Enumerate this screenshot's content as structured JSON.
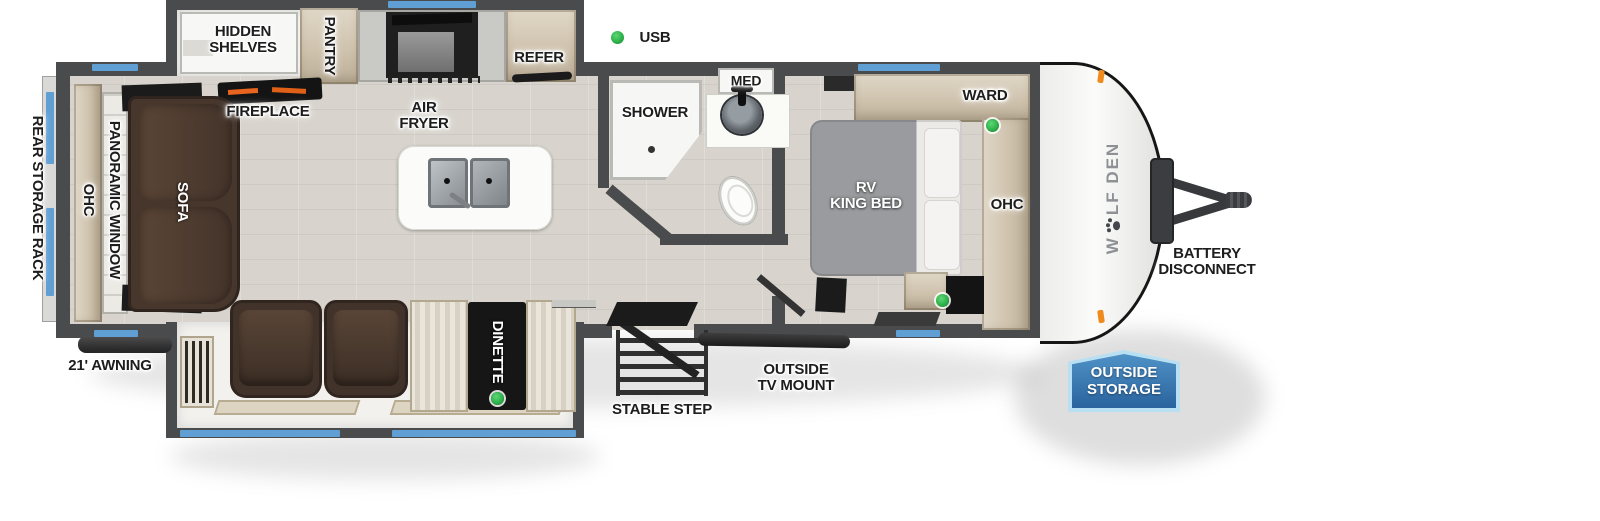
{
  "title": "WOLF DEN travel trailer floor plan",
  "brand": {
    "prefix": "W",
    "suffix": "LF DEN",
    "full_name": "WOLF DEN",
    "logo_icon": "paw-print-icon"
  },
  "legend": {
    "usb": "USB"
  },
  "labels": {
    "rear_storage_rack": "REAR STORAGE RACK",
    "ohc_rear": "OHC",
    "panoramic_window": "PANORAMIC WINDOW",
    "sofa": "SOFA",
    "hidden_shelves": "HIDDEN\nSHELVES",
    "fireplace": "FIREPLACE",
    "pantry": "PANTRY",
    "air_fryer": "AIR\nFRYER",
    "refer": "REFER",
    "shower": "SHOWER",
    "med": "MED",
    "ward": "WARD",
    "rv_king_bed": "RV\nKING BED",
    "ohc_bedroom": "OHC",
    "battery_disconnect": "BATTERY\nDISCONNECT",
    "outside_storage": "OUTSIDE\nSTORAGE",
    "awning": "21' AWNING",
    "dinette": "DINETTE",
    "stable_step": "STABLE STEP",
    "outside_tv_mount": "OUTSIDE\nTV MOUNT"
  },
  "colors": {
    "wall": "#4a4b4d",
    "window_accent": "#5f9fd4",
    "usb_green": "#2db24a",
    "floor": "#d8d4cd",
    "cabinet_tan": "#d5cab7",
    "sofa_brown": "#4a382c",
    "bed_gray": "#9a9b9e",
    "badge_blue": "#2f6ca8",
    "flame_orange": "#e8641f",
    "brand_gray": "#8d9194"
  }
}
